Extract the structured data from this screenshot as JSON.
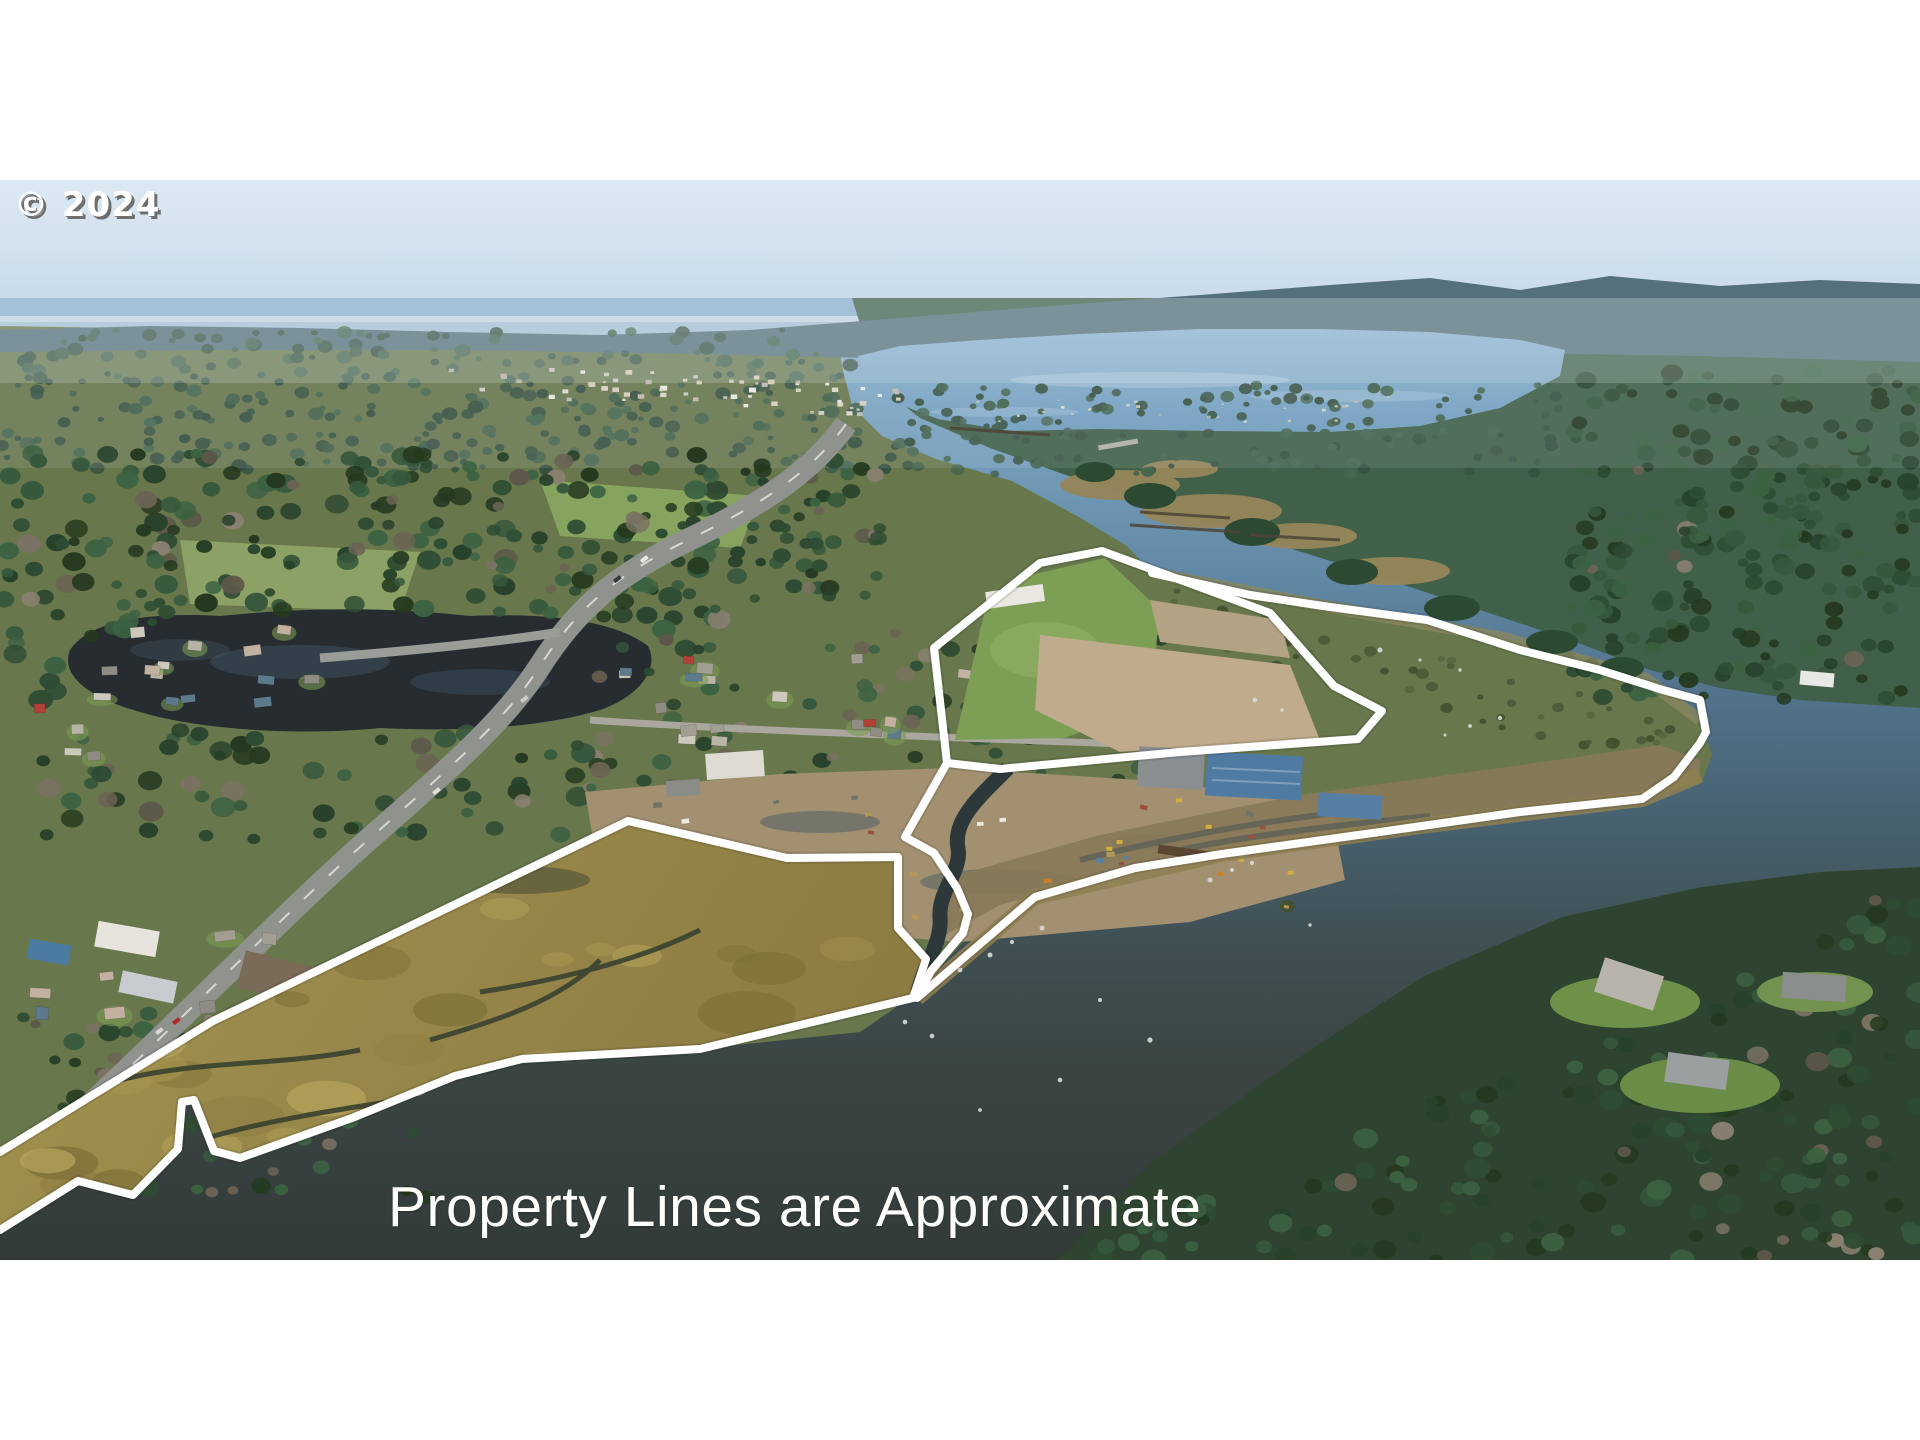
{
  "watermark": {
    "text": "© 2024"
  },
  "caption": {
    "text": "Property Lines are Approximate"
  },
  "photo": {
    "kind": "aerial-drone-photograph",
    "visible_features": [
      "sky",
      "distant-ocean-horizon",
      "coastal-town",
      "bay",
      "river",
      "highway",
      "residential-neighborhood",
      "tidal-marsh",
      "creek-channel",
      "industrial-yard",
      "forested-hills",
      "white-property-outline",
      "pilings"
    ],
    "colors": {
      "sky_top": "#d9e7f2",
      "sky_horizon": "#c3d7e8",
      "bay_water": "#7fa8c8",
      "river_upper": "#5f86a4",
      "channel_water": "#3a4440",
      "marsh_gold": "#9c8c4c",
      "forest_dark": "#2f4a33",
      "forest_far": "#54707a",
      "field_green": "#7d9e55",
      "yard_dirt": "#a29070",
      "road_gray": "#90938d",
      "property_line": "#ffffff"
    }
  }
}
